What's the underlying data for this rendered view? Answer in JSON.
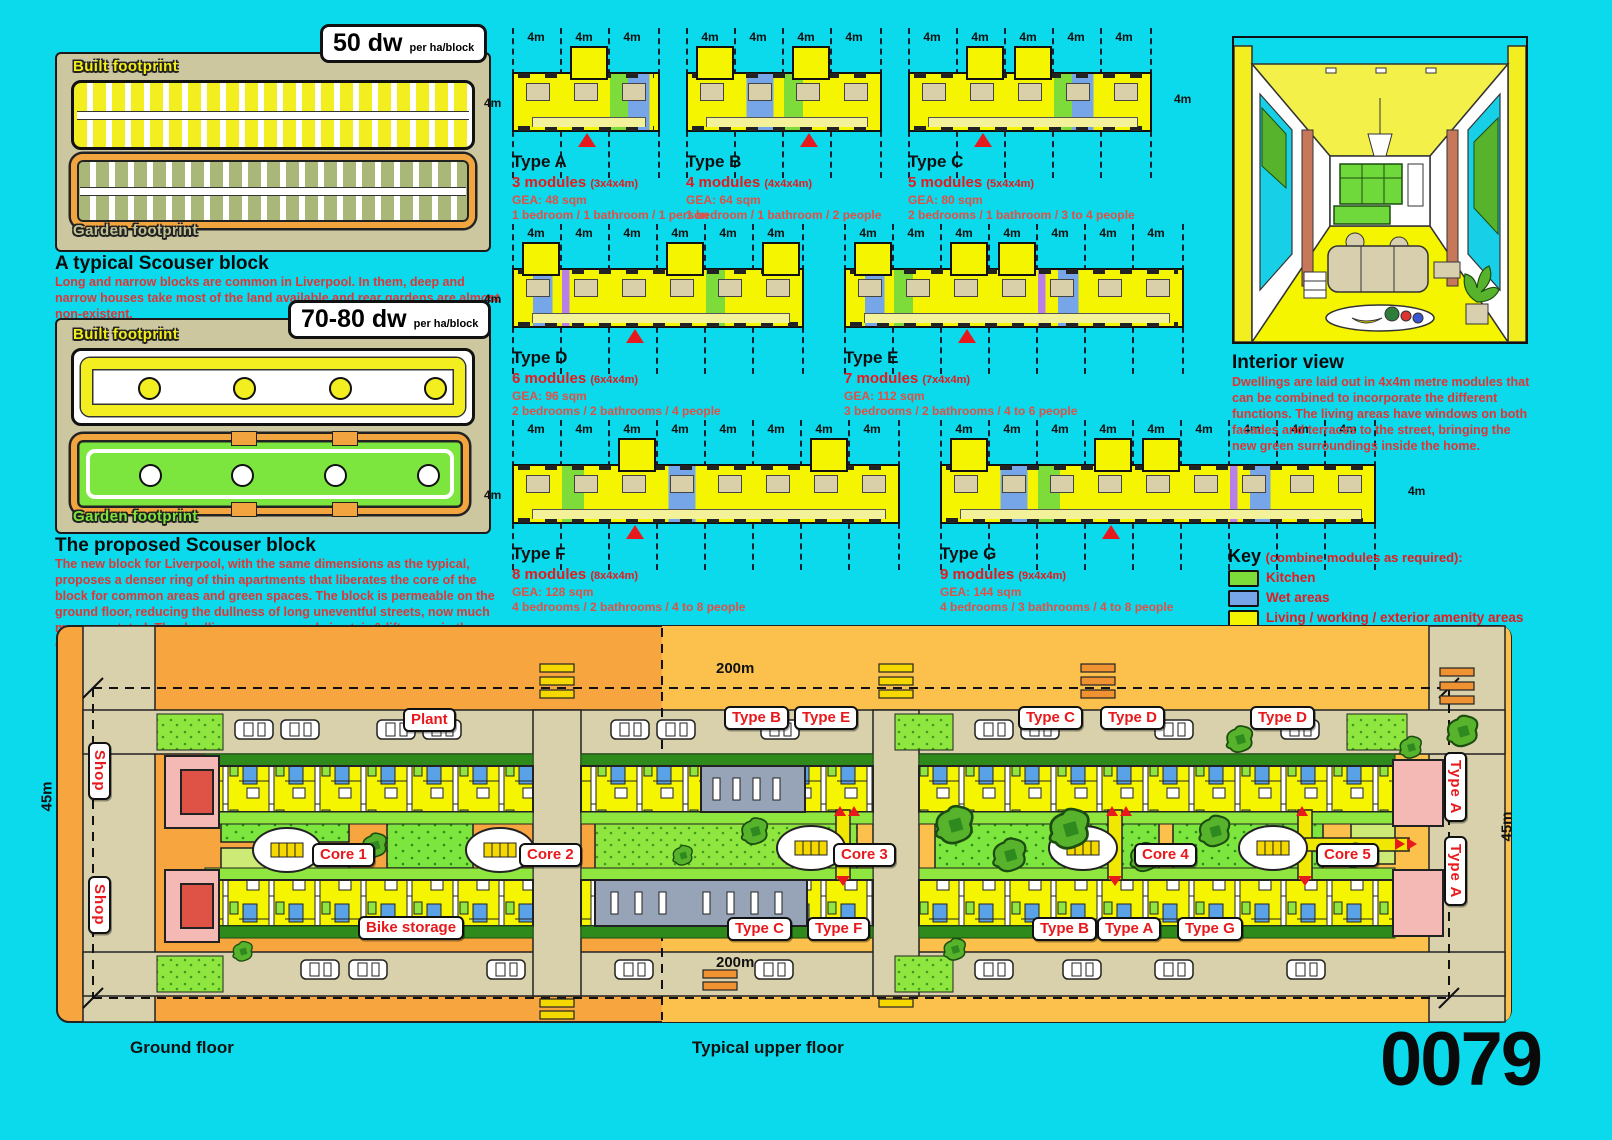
{
  "sheet_number": "0079",
  "dim_label": "4m",
  "typical_block": {
    "badge_value": "50 dw",
    "badge_unit": "per ha/block",
    "built_label": "Built footprint",
    "garden_label": "Garden footprint",
    "title": "A typical Scouser block",
    "description": "Long and narrow blocks are common in Liverpool. In them, deep and narrow houses take most of the land available and rear gardens are almost non-existent."
  },
  "proposed_block": {
    "badge_value": "70-80 dw",
    "badge_unit": "per ha/block",
    "built_label": "Built footprint",
    "garden_label": "Garden footprint",
    "title": "The proposed Scouser block",
    "description": "The new block for Liverpool, with the same dimensions as the typical, proposes a denser ring of thin apartments that liberates the core of the block for common areas and green spaces. The block is permeable on the ground floor, reducing the dullness of long uneventful streets, now much more vegetated. The dwellings are accessed via stair & lift cores in the courtyard, serving up to 16 flats each."
  },
  "types": [
    {
      "name": "Type A",
      "modules": "3 modules",
      "size": "(3x4x4m)",
      "gea": "GEA: 48 sqm",
      "occupancy": "1 bedroom / 1 bathroom / 1 person",
      "module_fills": [
        "Y",
        "Y",
        "GB"
      ],
      "terraces": [
        1
      ],
      "entry": 1
    },
    {
      "name": "Type B",
      "modules": "4 modules",
      "size": "(4x4x4m)",
      "gea": "GEA: 64 sqm",
      "occupancy": "1 bedroom / 1 bathroom / 2 people",
      "module_fills": [
        "Y",
        "B",
        "GY",
        "Y"
      ],
      "terraces": [
        0,
        2
      ],
      "entry": 2
    },
    {
      "name": "Type C",
      "modules": "5 modules",
      "size": "(5x4x4m)",
      "gea": "GEA: 80 sqm",
      "occupancy": "2 bedrooms / 1 bathroom / 3 to 4 people",
      "module_fills": [
        "Y",
        "Y",
        "Y",
        "GB",
        "Y"
      ],
      "terraces": [
        1,
        2
      ],
      "entry": 1
    },
    {
      "name": "Type D",
      "modules": "6 modules",
      "size": "(6x4x4m)",
      "gea": "GEA: 96 sqm",
      "occupancy": "2 bedrooms / 2 bathrooms / 4 people",
      "module_fills": [
        "YB",
        "PY",
        "Y",
        "Y",
        "GY",
        "Y"
      ],
      "terraces": [
        0,
        3,
        5
      ],
      "entry": 2
    },
    {
      "name": "Type E",
      "modules": "7 modules",
      "size": "(7x4x4m)",
      "gea": "GEA: 112 sqm",
      "occupancy": "3 bedrooms / 2 bathrooms / 4 to 6 people",
      "module_fills": [
        "YB",
        "GY",
        "Y",
        "Y",
        "PB",
        "Y",
        "Y"
      ],
      "terraces": [
        0,
        2,
        3
      ],
      "entry": 2
    },
    {
      "name": "Type F",
      "modules": "8 modules",
      "size": "(8x4x4m)",
      "gea": "GEA: 128 sqm",
      "occupancy": "4 bedrooms / 2 bathrooms / 4 to 8 people",
      "module_fills": [
        "Y",
        "G",
        "Y",
        "B",
        "Y",
        "Y",
        "Y",
        "Y"
      ],
      "terraces": [
        2,
        6
      ],
      "entry": 2
    },
    {
      "name": "Type G",
      "modules": "9 modules",
      "size": "(9x4x4m)",
      "gea": "GEA: 144 sqm",
      "occupancy": "4 bedrooms / 3 bathrooms / 4 to 8 people",
      "module_fills": [
        "Y",
        "B",
        "G",
        "Y",
        "Y",
        "Y",
        "PB",
        "Y",
        "Y"
      ],
      "terraces": [
        0,
        3,
        4
      ],
      "entry": 3
    }
  ],
  "interior": {
    "title": "Interior view",
    "description": "Dwellings are laid out in 4x4m metre modules that can be combined to incorporate the different functions. The living areas have windows on both facades and terraces to the street, bringing the new green surroundings inside the home."
  },
  "key": {
    "title": "Key",
    "subtitle": "(combine modules as required):",
    "items": [
      {
        "label": "Kitchen",
        "color": "#7ddc3a"
      },
      {
        "label": "Wet areas",
        "color": "#76a5e8"
      },
      {
        "label": "Living / working / exterior amenity areas",
        "color": "#f4f400"
      },
      {
        "label": "Movement",
        "color": "#f3f19a"
      }
    ]
  },
  "site_plan": {
    "dims": {
      "width_top": "200m",
      "width_bottom": "200m",
      "height_left": "45m",
      "height_right": "45m"
    },
    "labels": {
      "plant": "Plant",
      "shop": "Shop",
      "bike": "Bike storage"
    },
    "cores": [
      "Core 1",
      "Core 2",
      "Core 3",
      "Core 4",
      "Core 5"
    ],
    "top_types": [
      "Type B",
      "Type E",
      "Type C",
      "Type D",
      "Type D"
    ],
    "bottom_types": [
      "Type C",
      "Type F",
      "Type B",
      "Type A",
      "Type G"
    ],
    "right_types": [
      "Type A",
      "Type A"
    ],
    "captions": {
      "left": "Ground floor",
      "right": "Typical upper floor"
    }
  }
}
